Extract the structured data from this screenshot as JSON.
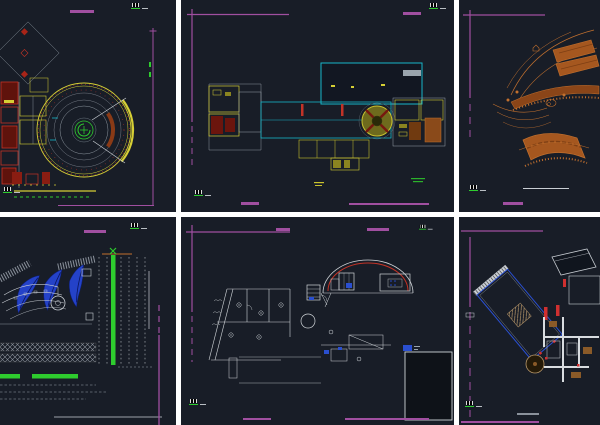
{
  "watermark": "DISAMAG.COM",
  "logo": {
    "arabic": "دیسامگ",
    "text": "DISAMAG"
  },
  "top_right_sheet": {
    "title": "First Floor Plan",
    "scale": "Scale 1/100"
  },
  "bottom_center_sheet": {
    "title": "Second Floor Plan"
  },
  "colors": {
    "panel_bg": "#181d27",
    "purple": "#a04fa0",
    "green_text": "#2f7c39",
    "cad_yellow": "#d6cf35",
    "cad_cyan": "#17b6c9",
    "cad_red": "#c23327",
    "cad_orange": "#c2702e",
    "leaf_blue": "#2442c8",
    "white_line": "#c9ced4",
    "bright_green": "#2ecc2e"
  }
}
